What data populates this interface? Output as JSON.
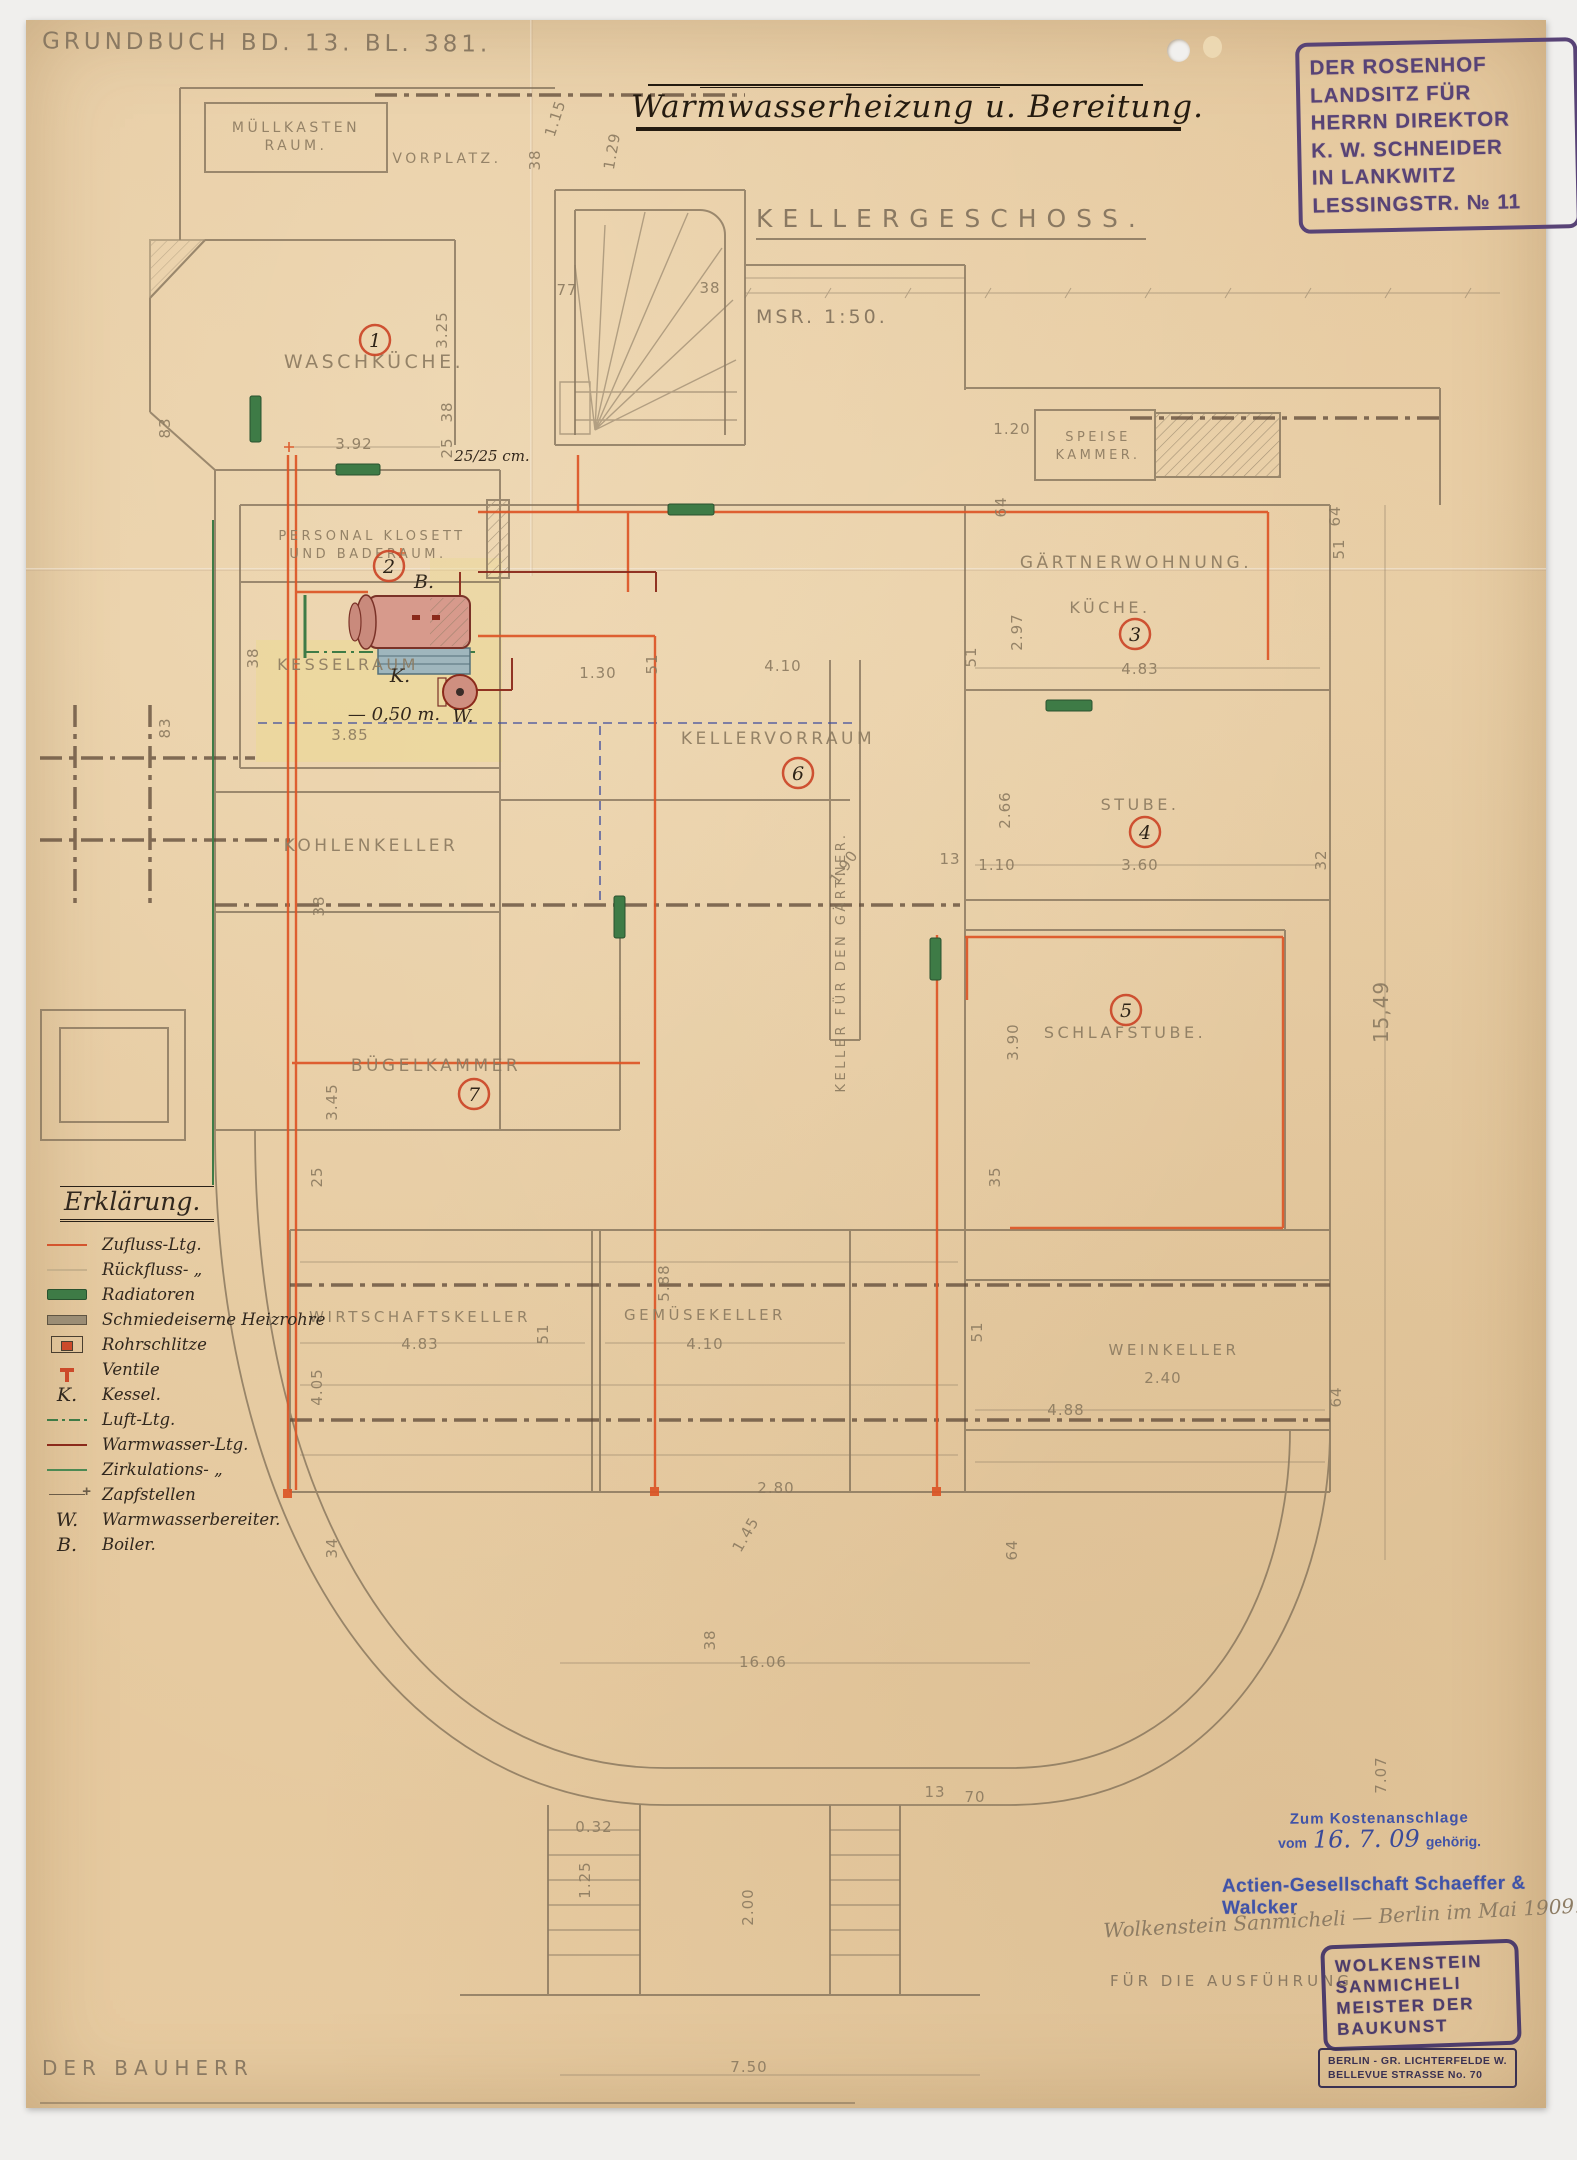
{
  "page": {
    "grundbuch": "Grundbuch Bd. 13. Bl. 381.",
    "title": "Warmwasserheizung u. Bereitung.",
    "floor": "Kellergeschoss.",
    "scale": "Msr. 1:50.",
    "bauherr": "Der Bauherr"
  },
  "colors": {
    "paper": "#e6c99f",
    "pencil": "#8b7a60",
    "stamp_purple": "#584376",
    "stamp_blue": "#4053a8",
    "pipe_supply_orange": "#dc5526",
    "pipe_hot_water_red": "#8b2a1b",
    "pipe_green": "#3e7b46",
    "circle_red": "#cb4527",
    "wash_yellow": "#ecd98f"
  },
  "owner_stamp": {
    "lines": [
      "DER ROSENHOF",
      "LANDSITZ FÜR",
      "HERRN DIREKTOR",
      "K. W. SCHNEIDER",
      "IN LANKWITZ",
      "LESSINGSTR. № 11"
    ]
  },
  "approval": {
    "kosten_line1": "Zum Kostenanschlage",
    "kosten_vom": "vom",
    "kosten_date": "16. 7. 09",
    "kosten_gehoerig": "gehörig.",
    "company": "Actien-Gesellschaft Schaeffer & Walcker",
    "signature": "Wolkenstein Sanmicheli — Berlin im Mai 1909.",
    "execution": "Für die Ausführung",
    "master_stamp": [
      "WOLKENSTEIN",
      "SANMICHELI",
      "MEISTER DER",
      "BAUKUNST"
    ],
    "address_stamp": [
      "BERLIN - GR. LICHTERFELDE W.",
      "BELLEVUE STRASSE No. 70"
    ]
  },
  "legend": {
    "title": "Erklärung.",
    "entries": [
      {
        "sym": "supply",
        "label": "Zufluss-Ltg."
      },
      {
        "sym": "return",
        "label": "Rückfluss- „"
      },
      {
        "sym": "radiator",
        "label": "Radiatoren"
      },
      {
        "sym": "iron",
        "label": "Schmiedeiserne Heizrohre"
      },
      {
        "sym": "slot",
        "label": "Rohrschlitze"
      },
      {
        "sym": "valve",
        "label": "Ventile"
      },
      {
        "sym": "letter",
        "letter": "K.",
        "label": "Kessel."
      },
      {
        "sym": "air",
        "label": "Luft-Ltg."
      },
      {
        "sym": "hot",
        "label": "Warmwasser-Ltg."
      },
      {
        "sym": "circ",
        "label": "Zirkulations- „"
      },
      {
        "sym": "tap",
        "label": "Zapfstellen"
      },
      {
        "sym": "letter",
        "letter": "W.",
        "label": "Warmwasserbereiter."
      },
      {
        "sym": "letter",
        "letter": "B.",
        "label": "Boiler."
      }
    ]
  },
  "plan": {
    "rooms": [
      {
        "t": "Müllkasten",
        "x": 296,
        "y": 132,
        "fs": 14
      },
      {
        "t": "Raum.",
        "x": 296,
        "y": 150,
        "fs": 14
      },
      {
        "t": "Vorplatz.",
        "x": 447,
        "y": 163,
        "fs": 14
      },
      {
        "t": "Waschküche.",
        "x": 374,
        "y": 368,
        "fs": 19
      },
      {
        "t": "Personal Klosett",
        "x": 372,
        "y": 540,
        "fs": 13
      },
      {
        "t": "und Baderaum.",
        "x": 368,
        "y": 558,
        "fs": 13
      },
      {
        "t": "Kesselraum",
        "x": 348,
        "y": 670,
        "fs": 16
      },
      {
        "t": "Speise",
        "x": 1098,
        "y": 441,
        "fs": 13
      },
      {
        "t": "Kammer.",
        "x": 1098,
        "y": 459,
        "fs": 13
      },
      {
        "t": "Gärtnerwohnung.",
        "x": 1136,
        "y": 568,
        "fs": 17
      },
      {
        "t": "Küche.",
        "x": 1110,
        "y": 613,
        "fs": 16
      },
      {
        "t": "Kellervorraum",
        "x": 778,
        "y": 744,
        "fs": 17
      },
      {
        "t": "Stube.",
        "x": 1140,
        "y": 810,
        "fs": 16
      },
      {
        "t": "Kohlenkeller",
        "x": 371,
        "y": 851,
        "fs": 17
      },
      {
        "t": "Keller für den Gärtner.",
        "x": 845,
        "y": 962,
        "fs": 13,
        "r": -90
      },
      {
        "t": "Schlafstube.",
        "x": 1125,
        "y": 1038,
        "fs": 16
      },
      {
        "t": "Bügelkammer",
        "x": 436,
        "y": 1071,
        "fs": 17
      },
      {
        "t": "Wirtschaftskeller",
        "x": 420,
        "y": 1322,
        "fs": 15
      },
      {
        "t": "Gemüsekeller",
        "x": 705,
        "y": 1320,
        "fs": 15
      },
      {
        "t": "Weinkeller",
        "x": 1174,
        "y": 1355,
        "fs": 15
      }
    ],
    "numbers": [
      {
        "n": "1",
        "x": 375,
        "y": 340
      },
      {
        "n": "2",
        "x": 389,
        "y": 566
      },
      {
        "n": "3",
        "x": 1135,
        "y": 634
      },
      {
        "n": "4",
        "x": 1145,
        "y": 832
      },
      {
        "n": "5",
        "x": 1126,
        "y": 1010
      },
      {
        "n": "6",
        "x": 798,
        "y": 773
      },
      {
        "n": "7",
        "x": 474,
        "y": 1094
      }
    ],
    "notes": [
      {
        "t": "25/25 cm.",
        "x": 492,
        "y": 461,
        "fs": 15
      },
      {
        "t": "B.",
        "x": 424,
        "y": 588,
        "fs": 19
      },
      {
        "t": "K.",
        "x": 400,
        "y": 682,
        "fs": 19
      },
      {
        "t": "W.",
        "x": 463,
        "y": 722,
        "fs": 18
      },
      {
        "t": "— 0,50 m.",
        "x": 394,
        "y": 720,
        "fs": 18
      }
    ],
    "dims": [
      {
        "t": "3.92",
        "x": 354,
        "y": 449
      },
      {
        "t": "83",
        "x": 170,
        "y": 428,
        "r": -90
      },
      {
        "t": "83",
        "x": 170,
        "y": 728,
        "r": -90
      },
      {
        "t": "38",
        "x": 452,
        "y": 412,
        "r": -90
      },
      {
        "t": "25",
        "x": 452,
        "y": 448,
        "r": -90
      },
      {
        "t": "3.25",
        "x": 447,
        "y": 330,
        "r": -90
      },
      {
        "t": "1.15",
        "x": 560,
        "y": 120,
        "r": -72
      },
      {
        "t": "38",
        "x": 540,
        "y": 160,
        "r": -90
      },
      {
        "t": "1.29",
        "x": 617,
        "y": 152,
        "r": -80
      },
      {
        "t": "77",
        "x": 567,
        "y": 295
      },
      {
        "t": "38",
        "x": 710,
        "y": 293
      },
      {
        "t": "1.20",
        "x": 1012,
        "y": 434
      },
      {
        "t": "64",
        "x": 1006,
        "y": 507,
        "r": -90
      },
      {
        "t": "64",
        "x": 1340,
        "y": 516,
        "r": -90
      },
      {
        "t": "51",
        "x": 1344,
        "y": 549,
        "r": -90
      },
      {
        "t": "2.97",
        "x": 1022,
        "y": 632,
        "r": -90
      },
      {
        "t": "51",
        "x": 976,
        "y": 657,
        "r": -90
      },
      {
        "t": "4.83",
        "x": 1140,
        "y": 674
      },
      {
        "t": "4.10",
        "x": 783,
        "y": 671
      },
      {
        "t": "1.30",
        "x": 598,
        "y": 678
      },
      {
        "t": "51",
        "x": 657,
        "y": 664,
        "r": -90
      },
      {
        "t": "2.66",
        "x": 1010,
        "y": 810,
        "r": -90
      },
      {
        "t": "1.10",
        "x": 997,
        "y": 870
      },
      {
        "t": "13",
        "x": 950,
        "y": 864
      },
      {
        "t": "1.90",
        "x": 848,
        "y": 870,
        "r": -55
      },
      {
        "t": "3.60",
        "x": 1140,
        "y": 870
      },
      {
        "t": "32",
        "x": 1326,
        "y": 860,
        "r": -90
      },
      {
        "t": "15,49",
        "x": 1388,
        "y": 1012,
        "r": -90,
        "fs": 20
      },
      {
        "t": "3.90",
        "x": 1018,
        "y": 1042,
        "r": -90
      },
      {
        "t": "35",
        "x": 1000,
        "y": 1177,
        "r": -90
      },
      {
        "t": "38",
        "x": 324,
        "y": 906,
        "r": -90
      },
      {
        "t": "3.45",
        "x": 337,
        "y": 1102,
        "r": -90
      },
      {
        "t": "25",
        "x": 322,
        "y": 1177,
        "r": -90
      },
      {
        "t": "5.88",
        "x": 669,
        "y": 1283,
        "r": -90
      },
      {
        "t": "4.83",
        "x": 420,
        "y": 1349
      },
      {
        "t": "51",
        "x": 548,
        "y": 1334,
        "r": -90
      },
      {
        "t": "4.05",
        "x": 322,
        "y": 1387,
        "r": -90
      },
      {
        "t": "34",
        "x": 337,
        "y": 1548,
        "r": -90
      },
      {
        "t": "4.10",
        "x": 705,
        "y": 1349
      },
      {
        "t": "51",
        "x": 982,
        "y": 1332,
        "r": -90
      },
      {
        "t": "2.40",
        "x": 1163,
        "y": 1383
      },
      {
        "t": "4.88",
        "x": 1066,
        "y": 1415
      },
      {
        "t": "64",
        "x": 1341,
        "y": 1397,
        "r": -90
      },
      {
        "t": "2.80",
        "x": 776,
        "y": 1493
      },
      {
        "t": "1.45",
        "x": 750,
        "y": 1537,
        "r": -60
      },
      {
        "t": "64",
        "x": 1017,
        "y": 1550,
        "r": -90
      },
      {
        "t": "38",
        "x": 715,
        "y": 1640,
        "r": -90
      },
      {
        "t": "16.06",
        "x": 763,
        "y": 1667
      },
      {
        "t": "13",
        "x": 935,
        "y": 1797
      },
      {
        "t": "70",
        "x": 975,
        "y": 1802
      },
      {
        "t": "0.32",
        "x": 594,
        "y": 1832
      },
      {
        "t": "1.25",
        "x": 590,
        "y": 1880,
        "r": -90
      },
      {
        "t": "2.00",
        "x": 753,
        "y": 1907,
        "r": -90
      },
      {
        "t": "7.50",
        "x": 749,
        "y": 2072
      },
      {
        "t": "3.85",
        "x": 350,
        "y": 740
      },
      {
        "t": "38",
        "x": 258,
        "y": 658,
        "r": -90
      },
      {
        "t": "7.07",
        "x": 1386,
        "y": 1775,
        "r": -90
      }
    ]
  }
}
